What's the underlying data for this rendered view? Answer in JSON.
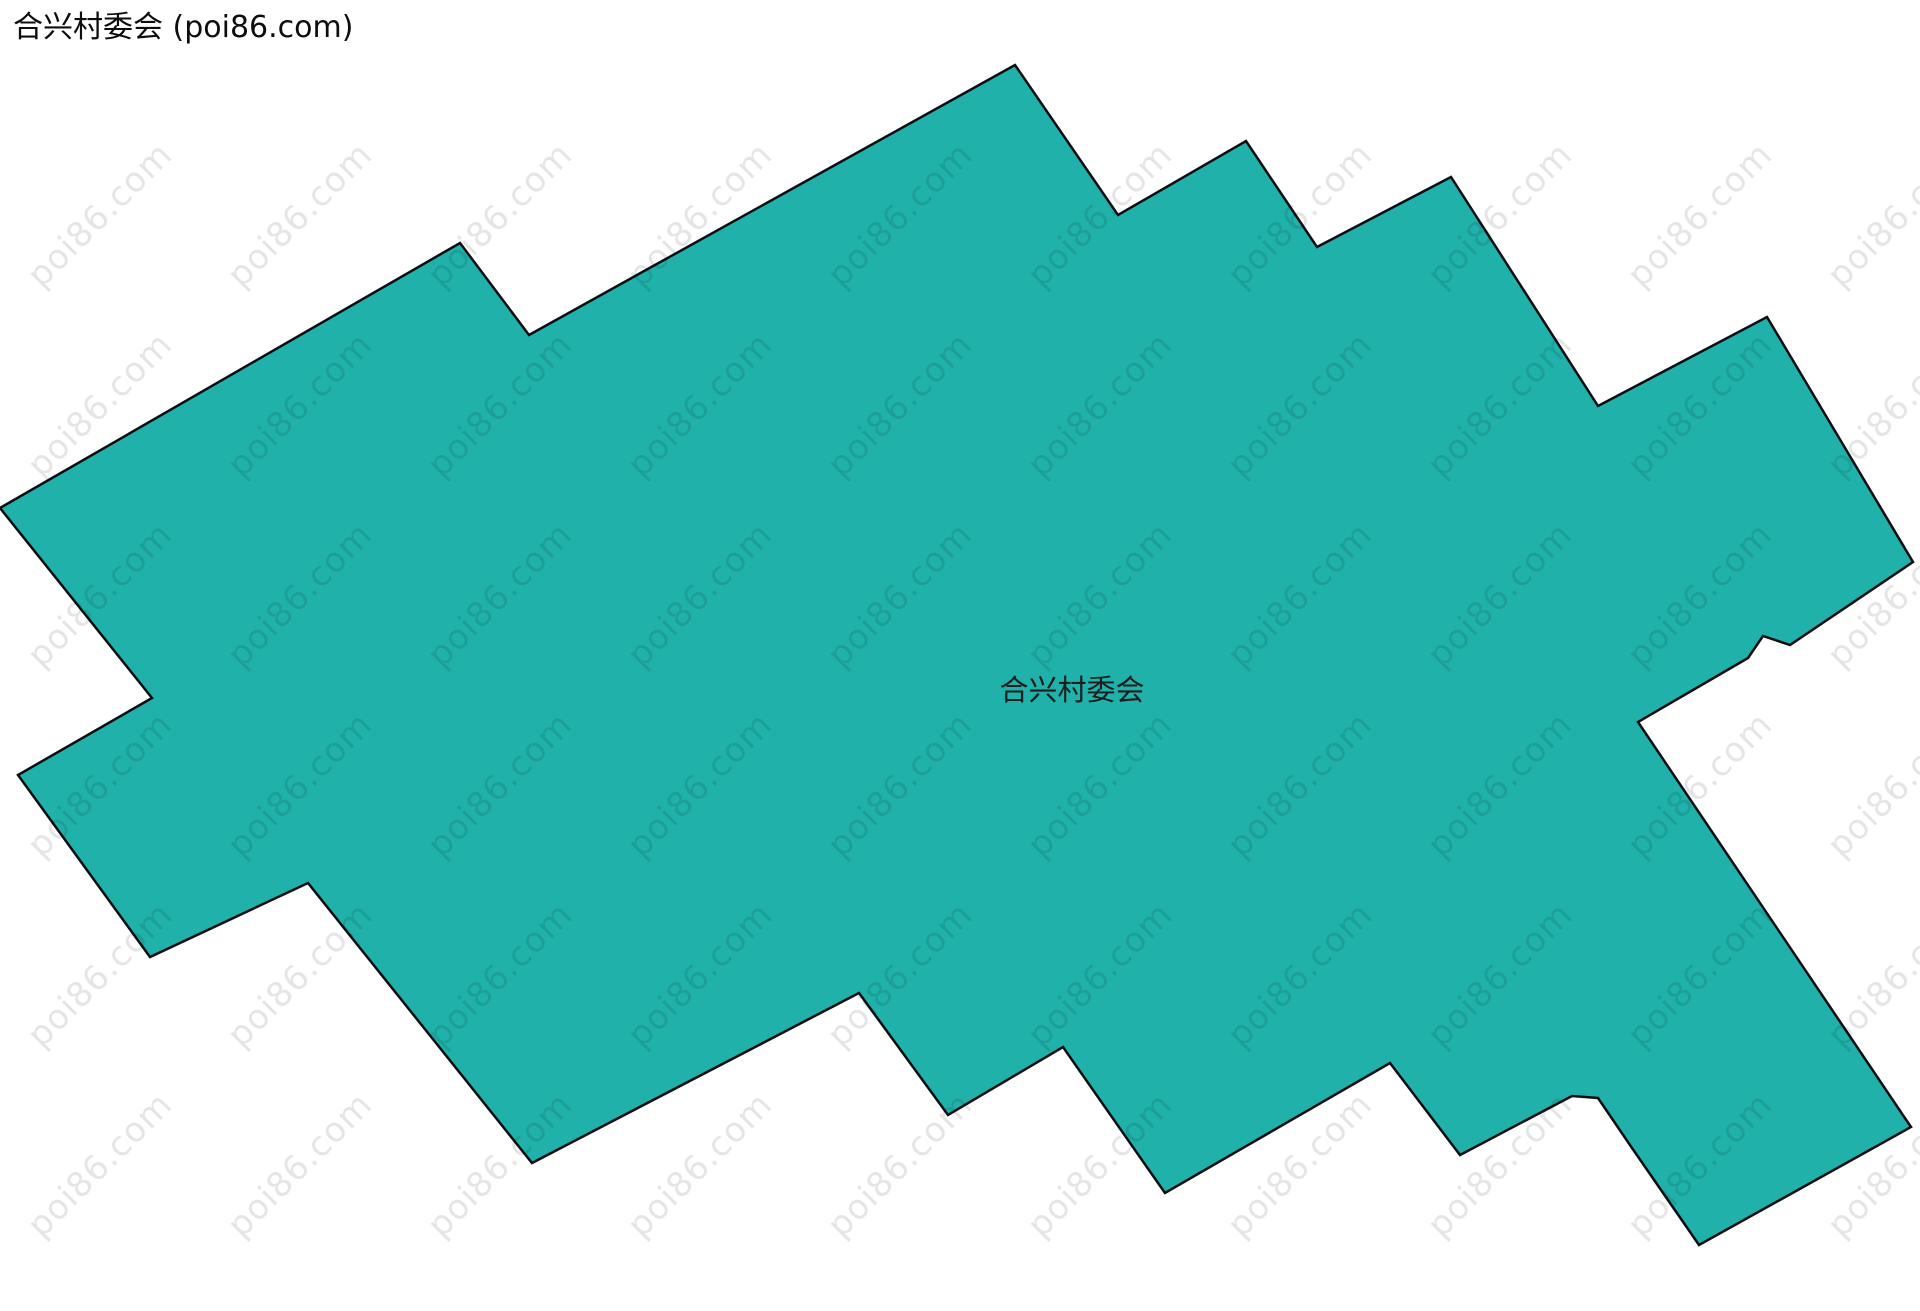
{
  "title": "合兴村委会 (poi86.com)",
  "map": {
    "region_label": "合兴村委会",
    "fill_color": "#20b2aa",
    "border_color": "#0d0d12",
    "border_width": 2.5,
    "polygon_points": "0,508 460,243 529,335 1015,65 1118,215 1246,141 1317,247 1451,177 1598,406 1767,317 1913,562 1790,645 1763,636 1748,658 1638,722 1911,1127 1699,1245 1632,1148 1598,1098 1572,1096 1460,1155 1390,1063 1165,1193 1063,1047 948,1115 859,993 532,1163 308,883 150,957 18,775 152,698"
  },
  "watermark": {
    "text": "poi86.com",
    "color": "rgba(0, 0, 0, 0.10)"
  }
}
